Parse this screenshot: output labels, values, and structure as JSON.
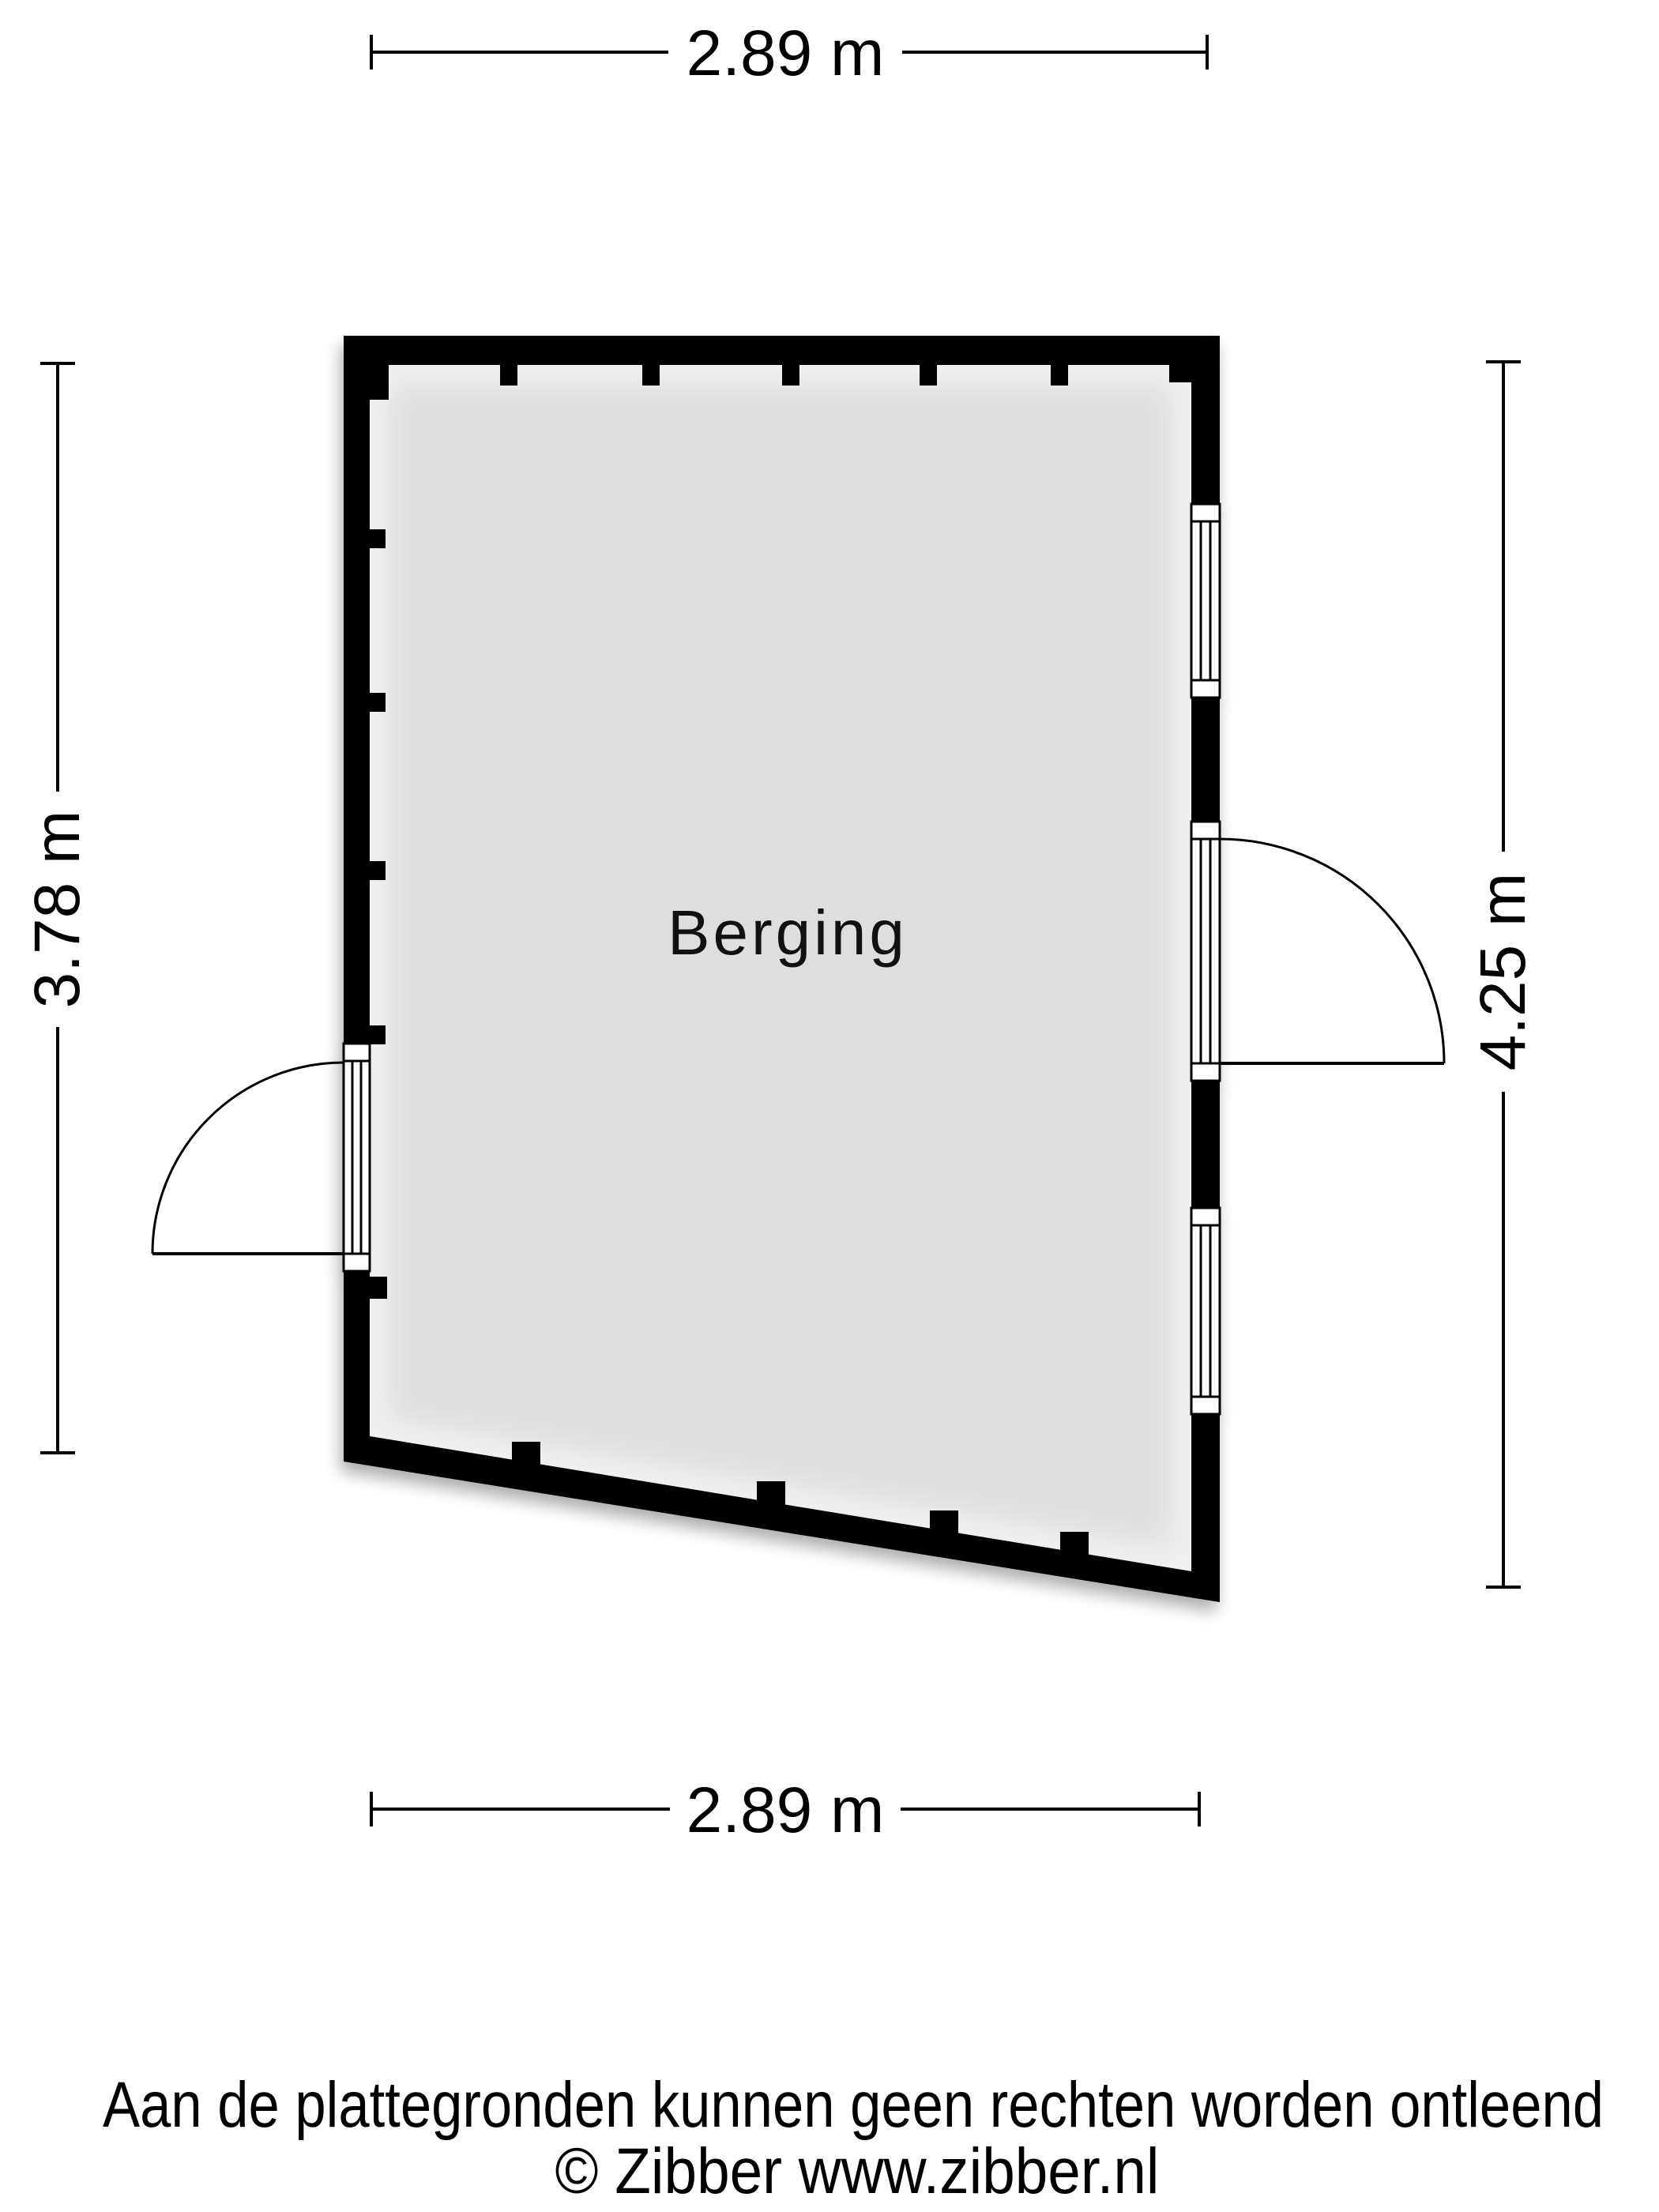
{
  "floorplan": {
    "room": {
      "label": "Berging"
    },
    "dimensions": {
      "top": "2.89 m",
      "bottom": "2.89 m",
      "left": "3.78 m",
      "right": "4.25 m"
    },
    "footer": {
      "disclaimer": "Aan de plattegronden kunnen geen rechten worden ontleend",
      "copyright": "© Zibber www.zibber.nl"
    },
    "colors": {
      "wall": "#000000",
      "room_fill": "#dedede",
      "line": "#000000",
      "background": "#ffffff"
    }
  }
}
